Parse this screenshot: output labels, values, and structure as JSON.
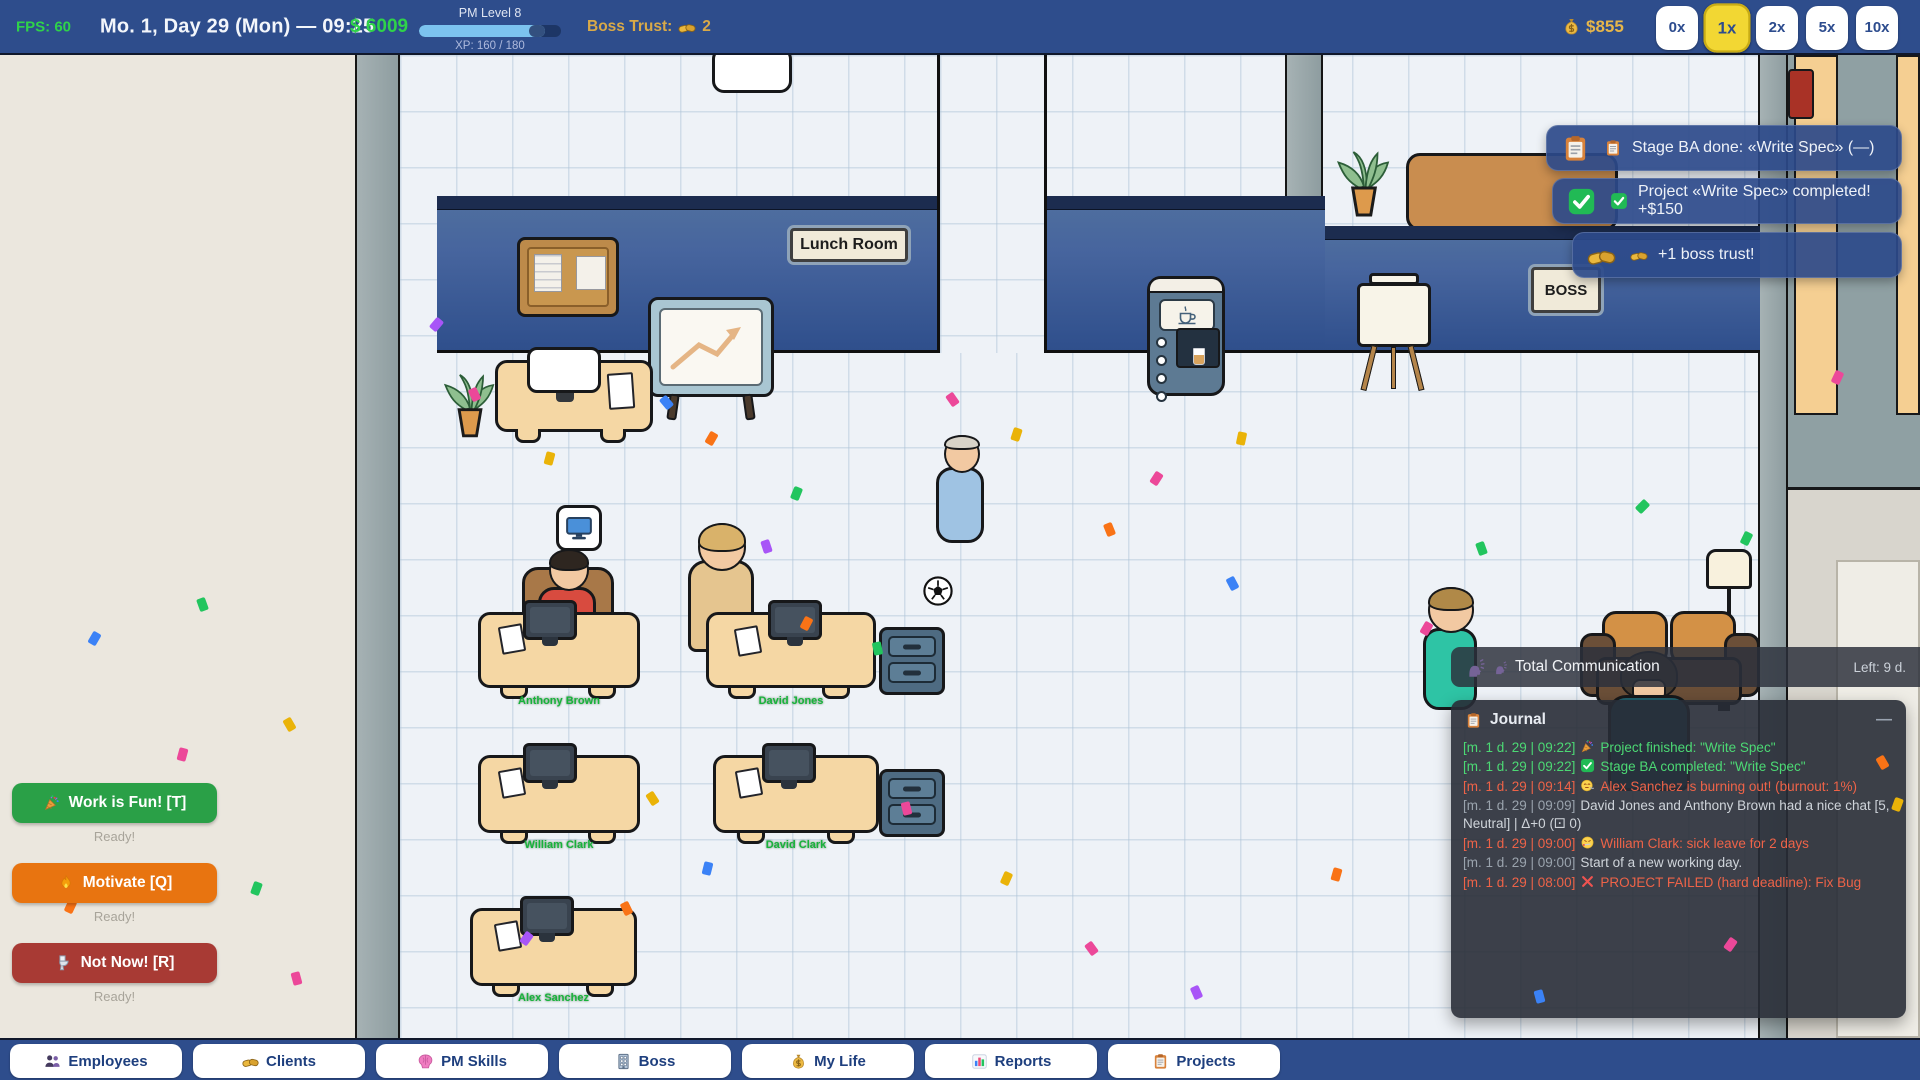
{
  "top_bar": {
    "fps": "FPS: 60",
    "datetime": "Mo. 1, Day 29 (Mon) — 09:25",
    "money": "$ 6009",
    "pm_level": "PM Level 8",
    "xp": "XP: 160 / 180",
    "xp_percent": 89,
    "boss_trust_label": "Boss Trust:",
    "boss_trust_icon": "handshake-icon",
    "boss_trust_value": "2",
    "wallet_icon": "moneybag-icon",
    "wallet": "$855",
    "speed_controls": [
      {
        "label": "0x",
        "active": false
      },
      {
        "label": "1x",
        "active": true
      },
      {
        "label": "2x",
        "active": false
      },
      {
        "label": "5x",
        "active": false
      },
      {
        "label": "10x",
        "active": false
      }
    ]
  },
  "toasts": [
    {
      "icon": "clipboard-icon",
      "text": "Stage BA done: «Write Spec» (—)"
    },
    {
      "icon": "check-icon",
      "text": "Project «Write Spec» completed! +$150"
    },
    {
      "icon": "handshake-icon",
      "text": "+1 boss trust!"
    }
  ],
  "comm_banner": {
    "icon": "speak-icon",
    "title": "Total Communication",
    "remaining": "Left: 9 d."
  },
  "journal": {
    "icon": "clipboard-icon",
    "title": "Journal",
    "collapse_label": "—",
    "entries": [
      {
        "ts": "[m. 1 d. 29 | 09:22]",
        "icon": "party-icon",
        "text": "Project finished: \"Write Spec\"",
        "type": "good"
      },
      {
        "ts": "[m. 1 d. 29 | 09:22]",
        "icon": "check-icon",
        "text": "Stage BA completed: \"Write Spec\"",
        "type": "good"
      },
      {
        "ts": "[m. 1 d. 29 | 09:14]",
        "icon": "exhale-face-icon",
        "text": "Alex Sanchez is burning out! (burnout: 1%)",
        "type": "bad"
      },
      {
        "ts": "[m. 1 d. 29 | 09:09]",
        "icon": "",
        "text": "David Jones and Anthony Brown had a nice chat [5, Neutral] | Δ+0 (⚀ 0)",
        "type": "neutral"
      },
      {
        "ts": "[m. 1 d. 29 | 09:00]",
        "icon": "sick-face-icon",
        "text": "William Clark: sick leave for 2 days",
        "type": "bad"
      },
      {
        "ts": "[m. 1 d. 29 | 09:00]",
        "icon": "",
        "text": "Start of a new working day.",
        "type": "neutral"
      },
      {
        "ts": "[m. 1 d. 29 | 08:00]",
        "icon": "x-icon",
        "text": "PROJECT FAILED (hard deadline): Fix Bug",
        "type": "bad"
      }
    ]
  },
  "action_panel": [
    {
      "icon": "party-icon",
      "label": "Work is Fun! [T]",
      "status": "Ready!",
      "color": "#2aa047"
    },
    {
      "icon": "flame-icon",
      "label": "Motivate [Q]",
      "status": "Ready!",
      "color": "#e87410"
    },
    {
      "icon": "toilet-icon",
      "label": "Not Now! [R]",
      "status": "Ready!",
      "color": "#a83a34"
    }
  ],
  "nav_tabs": [
    {
      "icon": "people-icon",
      "label": "Employees"
    },
    {
      "icon": "handshake-icon",
      "label": "Clients"
    },
    {
      "icon": "brain-icon",
      "label": "PM Skills"
    },
    {
      "icon": "building-icon",
      "label": "Boss"
    },
    {
      "icon": "moneybag-icon",
      "label": "My Life"
    },
    {
      "icon": "chart-icon",
      "label": "Reports"
    },
    {
      "icon": "clipboard-icon",
      "label": "Projects"
    }
  ],
  "world": {
    "lunch_room_sign": "Lunch Room",
    "boss_sign": "BOSS",
    "employees": [
      "Anthony Brown",
      "David Jones",
      "William Clark",
      "David Clark",
      "Alex Sanchez"
    ]
  },
  "colors": {
    "bar_blue": "#2e4d8c",
    "money_green": "#2fd24a",
    "gold": "#e3b23f",
    "active_speed_yellow": "#f2d733",
    "journal_good": "#4cd974",
    "journal_bad": "#ee6348",
    "floor": "#eef2f7",
    "wall_blue": "#3c5d99",
    "panel_beige": "#ebe7de",
    "name_green": "#17b33a"
  },
  "confetti": [
    {
      "x": 90,
      "y": 632,
      "color": "#3b82f6",
      "rot": 30,
      "layer": 1
    },
    {
      "x": 198,
      "y": 598,
      "color": "#22c55e",
      "rot": -20,
      "layer": 1
    },
    {
      "x": 178,
      "y": 748,
      "color": "#ec4899",
      "rot": 15,
      "layer": 1
    },
    {
      "x": 120,
      "y": 795,
      "color": "#22c55e",
      "rot": 40,
      "layer": 1
    },
    {
      "x": 285,
      "y": 718,
      "color": "#eab308",
      "rot": -30,
      "layer": 1
    },
    {
      "x": 252,
      "y": 882,
      "color": "#22c55e",
      "rot": 20,
      "layer": 1
    },
    {
      "x": 292,
      "y": 972,
      "color": "#ec4899",
      "rot": -15,
      "layer": 1
    },
    {
      "x": 66,
      "y": 900,
      "color": "#f97316",
      "rot": 25,
      "layer": 1
    },
    {
      "x": 432,
      "y": 318,
      "color": "#a855f7",
      "rot": 40,
      "layer": 1
    },
    {
      "x": 470,
      "y": 388,
      "color": "#ec4899",
      "rot": -25,
      "layer": 1
    },
    {
      "x": 545,
      "y": 452,
      "color": "#eab308",
      "rot": 15,
      "layer": 1
    },
    {
      "x": 662,
      "y": 396,
      "color": "#3b82f6",
      "rot": -40,
      "layer": 1
    },
    {
      "x": 707,
      "y": 432,
      "color": "#f97316",
      "rot": 30,
      "layer": 1
    },
    {
      "x": 762,
      "y": 540,
      "color": "#a855f7",
      "rot": -18,
      "layer": 1
    },
    {
      "x": 792,
      "y": 487,
      "color": "#22c55e",
      "rot": 22,
      "layer": 1
    },
    {
      "x": 948,
      "y": 393,
      "color": "#ec4899",
      "rot": -35,
      "layer": 1
    },
    {
      "x": 1012,
      "y": 428,
      "color": "#eab308",
      "rot": 18,
      "layer": 1
    },
    {
      "x": 1105,
      "y": 523,
      "color": "#f97316",
      "rot": -22,
      "layer": 1
    },
    {
      "x": 1152,
      "y": 472,
      "color": "#ec4899",
      "rot": 33,
      "layer": 1
    },
    {
      "x": 1228,
      "y": 577,
      "color": "#3b82f6",
      "rot": -28,
      "layer": 1
    },
    {
      "x": 1237,
      "y": 432,
      "color": "#eab308",
      "rot": 12,
      "layer": 1
    },
    {
      "x": 873,
      "y": 642,
      "color": "#22c55e",
      "rot": -12,
      "layer": 1
    },
    {
      "x": 802,
      "y": 617,
      "color": "#f97316",
      "rot": 28,
      "layer": 1
    },
    {
      "x": 648,
      "y": 792,
      "color": "#eab308",
      "rot": -33,
      "layer": 1
    },
    {
      "x": 703,
      "y": 862,
      "color": "#3b82f6",
      "rot": 14,
      "layer": 1
    },
    {
      "x": 622,
      "y": 902,
      "color": "#f97316",
      "rot": -26,
      "layer": 1
    },
    {
      "x": 522,
      "y": 932,
      "color": "#a855f7",
      "rot": 36,
      "layer": 1
    },
    {
      "x": 902,
      "y": 802,
      "color": "#ec4899",
      "rot": -14,
      "layer": 1
    },
    {
      "x": 1002,
      "y": 872,
      "color": "#eab308",
      "rot": 24,
      "layer": 1
    },
    {
      "x": 1087,
      "y": 942,
      "color": "#ec4899",
      "rot": -36,
      "layer": 1
    },
    {
      "x": 1332,
      "y": 868,
      "color": "#f97316",
      "rot": 16,
      "layer": 1
    },
    {
      "x": 1192,
      "y": 986,
      "color": "#a855f7",
      "rot": -24,
      "layer": 1
    },
    {
      "x": 1422,
      "y": 622,
      "color": "#ec4899",
      "rot": 30,
      "layer": 1
    },
    {
      "x": 1477,
      "y": 542,
      "color": "#22c55e",
      "rot": -20,
      "layer": 1
    },
    {
      "x": 1742,
      "y": 532,
      "color": "#22c55e",
      "rot": 26,
      "layer": 1
    },
    {
      "x": 1638,
      "y": 500,
      "color": "#22c55e",
      "rot": 45,
      "layer": 1
    },
    {
      "x": 1833,
      "y": 371,
      "color": "#ec4899",
      "rot": 25,
      "layer": 1
    },
    {
      "x": 1878,
      "y": 756,
      "color": "#f97316",
      "rot": -30,
      "layer": 2
    },
    {
      "x": 1893,
      "y": 798,
      "color": "#eab308",
      "rot": 20,
      "layer": 2
    },
    {
      "x": 1726,
      "y": 938,
      "color": "#ec4899",
      "rot": 35,
      "layer": 2
    },
    {
      "x": 1535,
      "y": 990,
      "color": "#3b82f6",
      "rot": -15,
      "layer": 2
    }
  ]
}
